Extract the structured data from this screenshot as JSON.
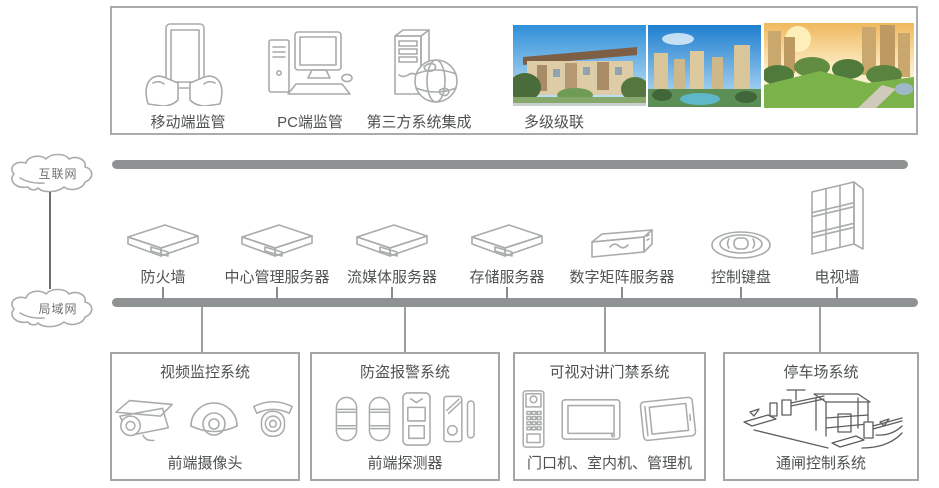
{
  "top_panel": {
    "items": [
      {
        "label": "移动端监管",
        "icon": "tablet-hands-icon"
      },
      {
        "label": "PC端监管",
        "icon": "desktop-pc-icon"
      },
      {
        "label": "第三方系统集成",
        "icon": "server-globe-icon"
      },
      {
        "label": "多级级联",
        "icon": "community-photos"
      }
    ]
  },
  "clouds": {
    "internet": "互联网",
    "lan": "局域网"
  },
  "middle_devices": [
    {
      "label": "防火墙",
      "icon": "rack-server-icon"
    },
    {
      "label": "中心管理服务器",
      "icon": "rack-server-icon"
    },
    {
      "label": "流媒体服务器",
      "icon": "rack-server-icon"
    },
    {
      "label": "存储服务器",
      "icon": "rack-server-icon"
    },
    {
      "label": "数字矩阵服务器",
      "icon": "matrix-server-icon"
    },
    {
      "label": "控制键盘",
      "icon": "control-keyboard-icon"
    },
    {
      "label": "电视墙",
      "icon": "tv-wall-icon"
    }
  ],
  "subsystems": [
    {
      "title": "视频监控系统",
      "caption": "前端摄像头",
      "icons": [
        "bullet-camera-icon",
        "dome-camera-icon",
        "ptz-camera-icon"
      ]
    },
    {
      "title": "防盗报警系统",
      "caption": "前端探测器",
      "icons": [
        "beam-detector-icon",
        "beam-detector-icon",
        "pir-detector-icon",
        "door-contact-icon"
      ]
    },
    {
      "title": "可视对讲门禁系统",
      "caption": "门口机、室内机、管理机",
      "icons": [
        "door-station-icon",
        "indoor-monitor-icon",
        "management-station-icon"
      ]
    },
    {
      "title": "停车场系统",
      "caption": "通闸控制系统",
      "icons": [
        "parking-gate-icon"
      ]
    }
  ],
  "colors": {
    "bar": "#8f9292",
    "text": "#4f5252",
    "icon_stroke": "#a9acac",
    "box_border": "#a3a6a6"
  }
}
